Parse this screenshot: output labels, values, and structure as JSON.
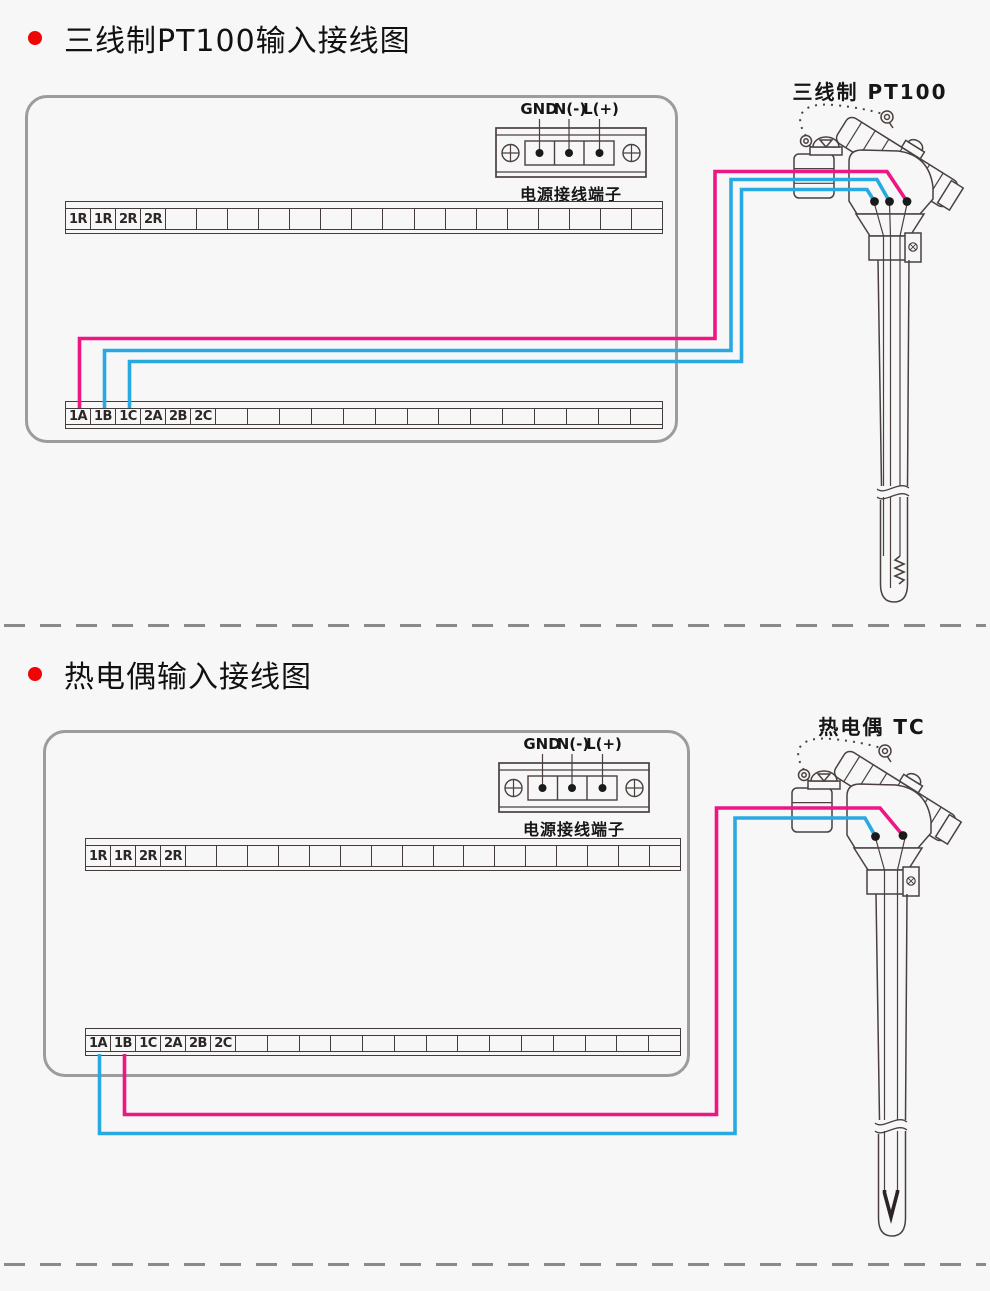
{
  "colors": {
    "line": "#4a4040",
    "panel_border": "#9c9c9c",
    "wire_pink": "#ec1784",
    "wire_blue": "#29a9e1",
    "dot_black": "#1a1a1a",
    "bullet_red": "#ee0505",
    "dash_gray": "#8a8a8a"
  },
  "sections": [
    {
      "title": "三线制PT100输入接线图",
      "sensor_label": "三线制 PT100",
      "power": {
        "labels": [
          "GND",
          "N(-)",
          "L(+)"
        ],
        "caption": "电源接线端子"
      },
      "top_strip": {
        "labels": [
          "1R",
          "1R",
          "2R",
          "2R"
        ],
        "empty_cells": 16
      },
      "bottom_strip": {
        "labels": [
          "1A",
          "1B",
          "1C",
          "2A",
          "2B",
          "2C"
        ],
        "empty_cells": 14
      },
      "wired_terminals": [
        "1A",
        "1B",
        "1C"
      ],
      "sensor_tip": "resistor"
    },
    {
      "title": "热电偶输入接线图",
      "sensor_label": "热电偶 TC",
      "power": {
        "labels": [
          "GND",
          "N(-)",
          "L(+)"
        ],
        "caption": "电源接线端子"
      },
      "top_strip": {
        "labels": [
          "1R",
          "1R",
          "2R",
          "2R"
        ],
        "empty_cells": 16
      },
      "bottom_strip": {
        "labels": [
          "1A",
          "1B",
          "1C",
          "2A",
          "2B",
          "2C"
        ],
        "empty_cells": 14
      },
      "wired_terminals": [
        "1A",
        "1B"
      ],
      "sensor_tip": "junction"
    }
  ]
}
